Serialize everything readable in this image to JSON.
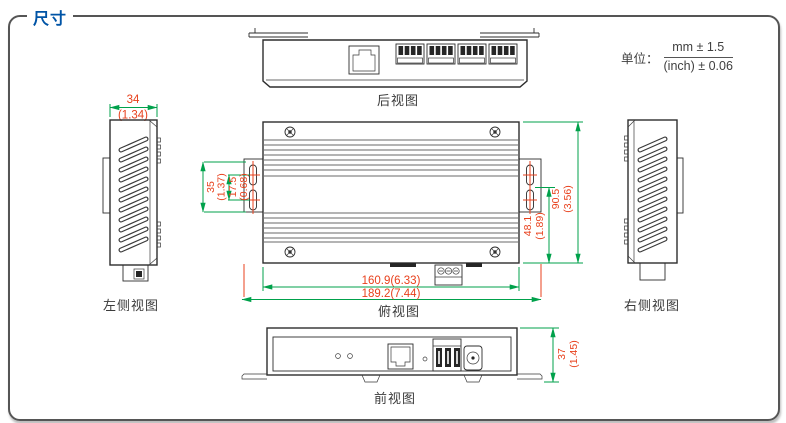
{
  "title": "尺寸",
  "units": {
    "label": "单位：",
    "mm": "mm ± 1.5",
    "inch": "(inch) ± 0.06"
  },
  "views": {
    "rear": "后视图",
    "left": "左侧视图",
    "top": "俯视图",
    "right": "右侧视图",
    "front": "前视图"
  },
  "dims": {
    "side_width_mm": "34",
    "side_width_in": "(1.34)",
    "ear_height_mm": "35",
    "ear_height_in": "(1.37)",
    "hole_pitch_mm": "17.5",
    "hole_pitch_in": "(0.68)",
    "body_width": "160.9(6.33)",
    "overall_width": "189.2(7.44)",
    "hole_to_edge_mm": "48.1",
    "hole_to_edge_in": "(1.89)",
    "body_depth_mm": "90.5",
    "body_depth_in": "(3.56)",
    "front_height_mm": "37",
    "front_height_in": "(1.45)"
  },
  "colors": {
    "accent": "#0054a6",
    "dim-red": "#e8401c",
    "dim-green": "#00a14b"
  }
}
